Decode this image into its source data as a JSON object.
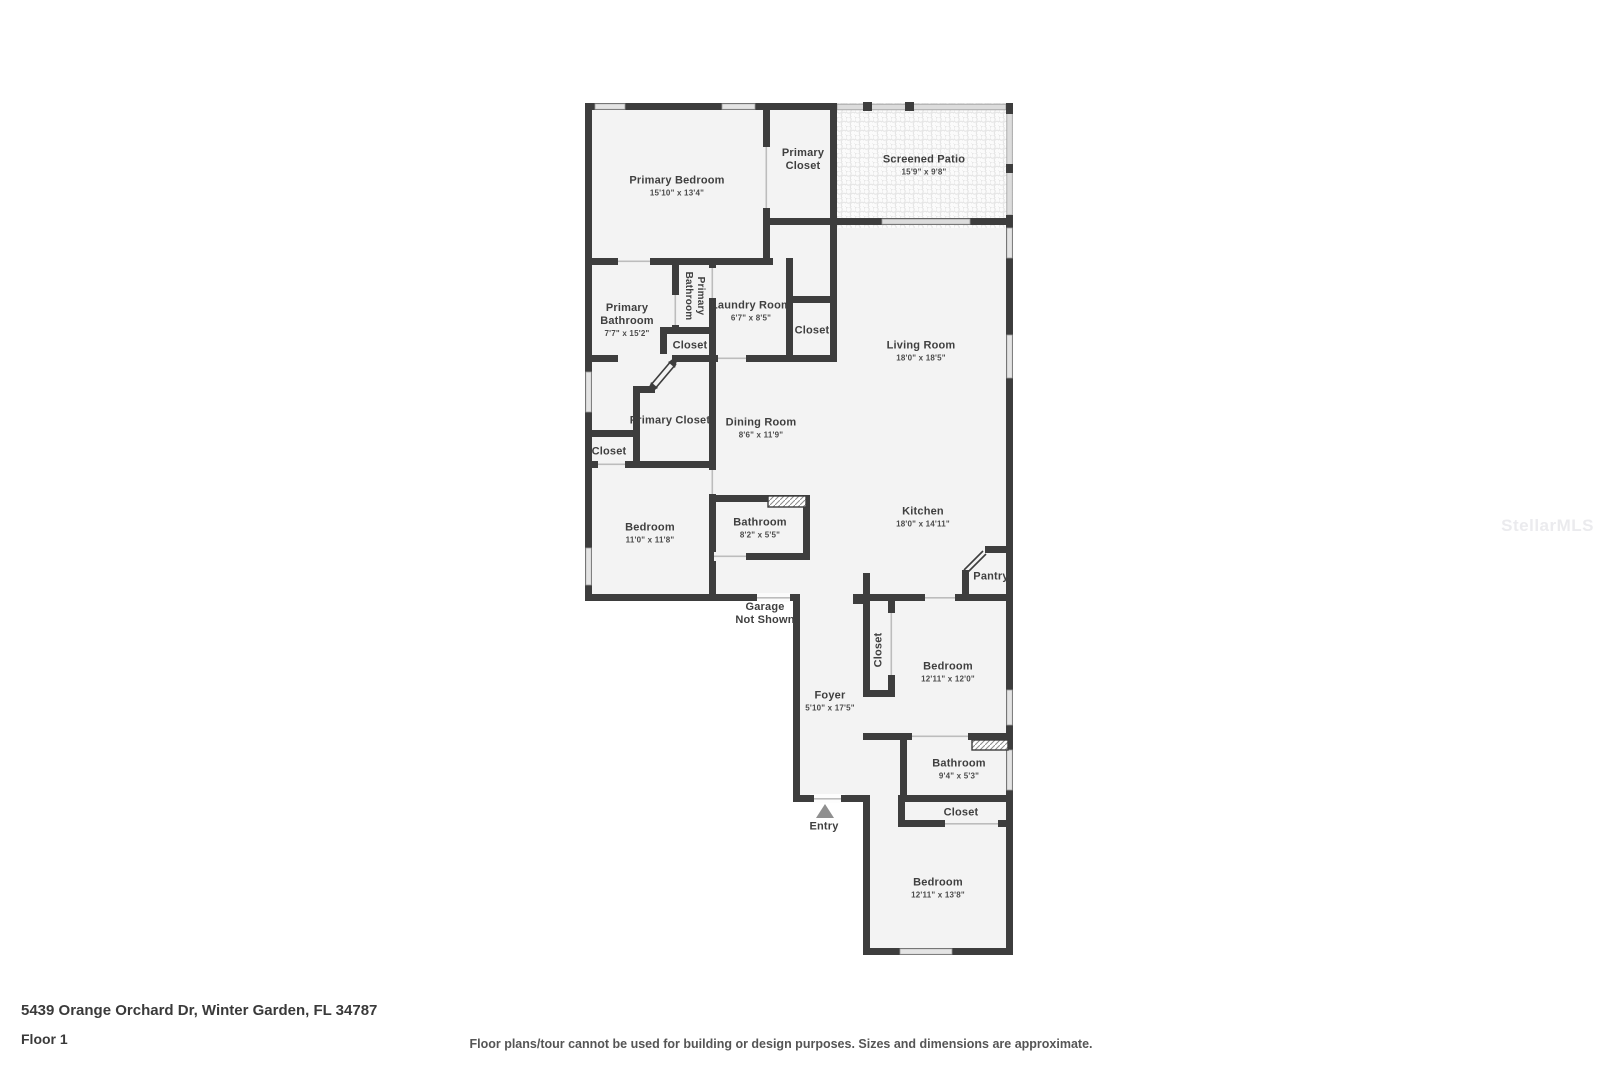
{
  "meta": {
    "address": "5439 Orange Orchard Dr, Winter Garden, FL 34787",
    "floor": "Floor 1",
    "disclaimer": "Floor plans/tour cannot be used for building or design purposes. Sizes and dimensions are approximate.",
    "watermark": "StellarMLS",
    "entry_label": "Entry",
    "garage_note": {
      "line1": "Garage",
      "line2": "Not Shown"
    }
  },
  "colors": {
    "wall": "#3d3d3d",
    "floor": "#f3f3f3",
    "window": "#e4e4e4",
    "screen": "#dcdcdc",
    "entry_marker": "#8f8f8f",
    "watermark": "#ebebee"
  },
  "rooms": {
    "primary_bedroom": {
      "name": "Primary Bedroom",
      "dims": "15'10\" x 13'4\""
    },
    "primary_closet_top": {
      "name": "Primary Closet",
      "dims": ""
    },
    "screened_patio": {
      "name": "Screened Patio",
      "dims": "15'9\" x 9'8\""
    },
    "primary_bathroom": {
      "name": "Primary Bathroom",
      "dims": "7'7\" x 15'2\""
    },
    "primary_bathroom_wc": {
      "name": "Primary Bathroom",
      "dims": ""
    },
    "laundry_room": {
      "name": "Laundry Room",
      "dims": "6'7\" x 8'5\""
    },
    "closet_laundry": {
      "name": "Closet",
      "dims": ""
    },
    "closet_wc": {
      "name": "Closet",
      "dims": ""
    },
    "living_room": {
      "name": "Living Room",
      "dims": "18'0\" x 18'5\""
    },
    "primary_closet_lower": {
      "name": "Primary Closet",
      "dims": ""
    },
    "dining_room": {
      "name": "Dining Room",
      "dims": "8'6\" x 11'9\""
    },
    "closet_left": {
      "name": "Closet",
      "dims": ""
    },
    "bedroom_left": {
      "name": "Bedroom",
      "dims": "11'0\" x 11'8\""
    },
    "bathroom_mid": {
      "name": "Bathroom",
      "dims": "8'2\" x 5'5\""
    },
    "kitchen": {
      "name": "Kitchen",
      "dims": "18'0\" x 14'11\""
    },
    "pantry": {
      "name": "Pantry",
      "dims": ""
    },
    "closet_foyer": {
      "name": "Closet",
      "dims": ""
    },
    "bedroom_right": {
      "name": "Bedroom",
      "dims": "12'11\" x 12'0\""
    },
    "foyer": {
      "name": "Foyer",
      "dims": "5'10\" x 17'5\""
    },
    "bathroom_right": {
      "name": "Bathroom",
      "dims": "9'4\" x 5'3\""
    },
    "closet_bath": {
      "name": "Closet",
      "dims": ""
    },
    "bedroom_bottom": {
      "name": "Bedroom",
      "dims": "12'11\" x 13'8\""
    }
  }
}
